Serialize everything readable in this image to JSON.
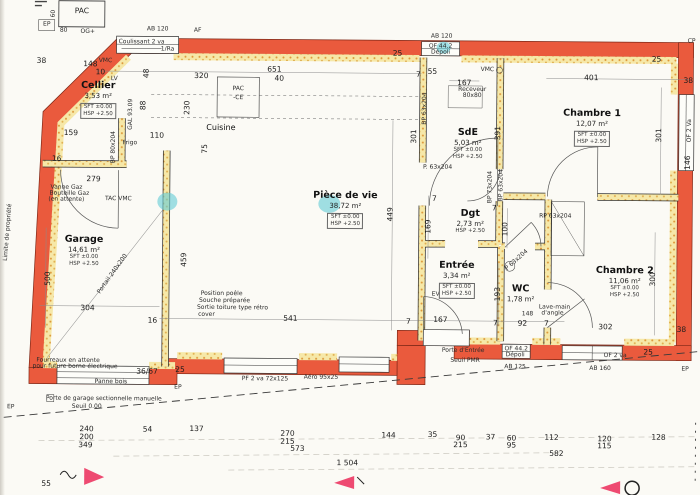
{
  "colors": {
    "wall_red": "#ea5a3d",
    "wall_edge": "#7f2817",
    "hatch_yellow": "#f6e8a8",
    "hatch_dot": "#dd9738",
    "highlight_cyan": "#63ccd6",
    "marker_pink": "#ee4a71",
    "paper": "#fbfaf5",
    "ink": "#1c1c1c"
  },
  "rooms": [
    {
      "name": "Cellier",
      "area": "3,53 m²",
      "info": [
        "SFT ±0.00",
        "HSP +2.50"
      ],
      "boxed": true,
      "x": 97,
      "y": 82
    },
    {
      "name": "Garage",
      "area": "14,61 m²",
      "info": [
        "SFT ±0.00",
        "HSP +2.50"
      ],
      "boxed": false,
      "x": 84,
      "y": 236
    },
    {
      "name": "Cuisine",
      "area": "",
      "info": [],
      "boxed": false,
      "x": 220,
      "y": 124,
      "small": true
    },
    {
      "name": "Pièce de vie",
      "area": "38,72 m²",
      "info": [
        "SFT ±0.00",
        "HSP +2.50"
      ],
      "boxed": true,
      "x": 345,
      "y": 190
    },
    {
      "name": "SdE",
      "area": "5,03 m²",
      "info": [
        "SFT ±0.00",
        "HSP +2.50"
      ],
      "boxed": false,
      "x": 467,
      "y": 126
    },
    {
      "name": "Chambre 1",
      "area": "12,07 m²",
      "info": [
        "SFT ±0.00",
        "HSP +2.50"
      ],
      "boxed": true,
      "x": 591,
      "y": 106
    },
    {
      "name": "Dgt",
      "area": "2,73 m²",
      "info": [
        "HSP +2.50"
      ],
      "boxed": false,
      "x": 470,
      "y": 207
    },
    {
      "name": "Entrée",
      "area": "3,34 m²",
      "info": [
        "SFT ±0.00",
        "HSP +2.50"
      ],
      "boxed": true,
      "x": 457,
      "y": 259
    },
    {
      "name": "WC",
      "area": "1,78 m²",
      "info": [],
      "boxed": false,
      "x": 521,
      "y": 282
    },
    {
      "name": "Chambre 2",
      "area": "11,06 m²",
      "info": [
        "SFT ±0.00",
        "HSP +2.50"
      ],
      "boxed": false,
      "x": 625,
      "y": 263
    }
  ],
  "labels": [
    {
      "t": "PAC",
      "x": 80,
      "y": 13,
      "c": "d"
    },
    {
      "t": "60",
      "x": 52,
      "y": 16,
      "c": "t",
      "r": -90
    },
    {
      "t": "80",
      "x": 62,
      "y": 33,
      "c": "t"
    },
    {
      "t": "OG+",
      "x": 86,
      "y": 34,
      "c": "t"
    },
    {
      "t": "EP",
      "x": 45,
      "y": 27,
      "c": "t"
    },
    {
      "t": "AB 120",
      "x": 156,
      "y": 31,
      "c": "t"
    },
    {
      "t": "Coulissant 2 va",
      "x": 140,
      "y": 44,
      "c": "t"
    },
    {
      "t": "1/Ra",
      "x": 166,
      "y": 51,
      "c": "t"
    },
    {
      "t": "AF",
      "x": 196,
      "y": 32,
      "c": "t"
    },
    {
      "t": "38",
      "x": 40,
      "y": 63,
      "c": "d"
    },
    {
      "t": "VMC",
      "x": 104,
      "y": 63,
      "c": "t"
    },
    {
      "t": "148",
      "x": 89,
      "y": 66,
      "c": "d"
    },
    {
      "t": "10",
      "x": 99,
      "y": 74,
      "c": "d"
    },
    {
      "t": "LV",
      "x": 113,
      "y": 81,
      "c": "t"
    },
    {
      "t": "48",
      "x": 145,
      "y": 75,
      "c": "d",
      "r": -90
    },
    {
      "t": "320",
      "x": 200,
      "y": 77,
      "c": "d"
    },
    {
      "t": "651",
      "x": 273,
      "y": 70,
      "c": "d"
    },
    {
      "t": "40",
      "x": 278,
      "y": 79,
      "c": "d"
    },
    {
      "t": "25",
      "x": 396,
      "y": 53,
      "c": "d"
    },
    {
      "t": "AB 120",
      "x": 440,
      "y": 36,
      "c": "t"
    },
    {
      "t": "OF 44.2",
      "x": 439,
      "y": 46,
      "c": "t"
    },
    {
      "t": "Dépoli",
      "x": 439,
      "y": 52,
      "c": "t"
    },
    {
      "t": "55",
      "x": 431,
      "y": 71,
      "c": "d"
    },
    {
      "t": "7",
      "x": 417,
      "y": 74,
      "c": "d"
    },
    {
      "t": "167",
      "x": 463,
      "y": 82,
      "c": "d"
    },
    {
      "t": "Receveur",
      "x": 471,
      "y": 89,
      "c": "t"
    },
    {
      "t": "80x80",
      "x": 471,
      "y": 95,
      "c": "t"
    },
    {
      "t": "VMC",
      "x": 486,
      "y": 69,
      "c": "t"
    },
    {
      "t": "401",
      "x": 590,
      "y": 76,
      "c": "d"
    },
    {
      "t": "25",
      "x": 655,
      "y": 57,
      "c": "d"
    },
    {
      "t": "38",
      "x": 687,
      "y": 78,
      "c": "d"
    },
    {
      "t": "CP",
      "x": 690,
      "y": 39,
      "c": "t"
    },
    {
      "t": "PAC",
      "x": 237,
      "y": 90,
      "c": "t"
    },
    {
      "t": "-CE",
      "x": 237,
      "y": 99,
      "c": "t"
    },
    {
      "t": "88",
      "x": 142,
      "y": 107,
      "c": "d",
      "r": -90
    },
    {
      "t": "230",
      "x": 186,
      "y": 109,
      "c": "d",
      "r": -90
    },
    {
      "t": "GAL 93.09",
      "x": 130,
      "y": 116,
      "c": "t",
      "r": -90
    },
    {
      "t": "BP 80x204",
      "x": 113,
      "y": 149,
      "c": "t",
      "r": -90
    },
    {
      "t": "Frigo",
      "x": 129,
      "y": 145,
      "c": "t"
    },
    {
      "t": "110",
      "x": 156,
      "y": 137,
      "c": "d"
    },
    {
      "t": "75",
      "x": 204,
      "y": 150,
      "c": "d",
      "r": -90
    },
    {
      "t": "159",
      "x": 70,
      "y": 135,
      "c": "d"
    },
    {
      "t": "16",
      "x": 56,
      "y": 161,
      "c": "d"
    },
    {
      "t": "279",
      "x": 93,
      "y": 181,
      "c": "d"
    },
    {
      "t": "TAC VMC",
      "x": 118,
      "y": 201,
      "c": "t"
    },
    {
      "t": "Vanne Gaz",
      "x": 66,
      "y": 190,
      "c": "t"
    },
    {
      "t": "Bouteille Gaz",
      "x": 69,
      "y": 196,
      "c": "t"
    },
    {
      "t": "(en attente)",
      "x": 66,
      "y": 202,
      "c": "t"
    },
    {
      "t": "500",
      "x": 48,
      "y": 281,
      "c": "d",
      "r": -90
    },
    {
      "t": "459",
      "x": 184,
      "y": 261,
      "c": "d",
      "r": -90
    },
    {
      "t": "Portail 240x200",
      "x": 113,
      "y": 276,
      "c": "t",
      "r": -55
    },
    {
      "t": "304",
      "x": 88,
      "y": 310,
      "c": "d"
    },
    {
      "t": "16",
      "x": 153,
      "y": 322,
      "c": "d"
    },
    {
      "t": "Position poêle",
      "x": 222,
      "y": 295,
      "c": "t"
    },
    {
      "t": "Souche préparée",
      "x": 225,
      "y": 302,
      "c": "t"
    },
    {
      "t": "Sortie toiture type rétro",
      "x": 233,
      "y": 309,
      "c": "t"
    },
    {
      "t": "cover",
      "x": 207,
      "y": 316,
      "c": "t"
    },
    {
      "t": "541",
      "x": 291,
      "y": 319,
      "c": "d"
    },
    {
      "t": "7",
      "x": 409,
      "y": 321,
      "c": "d"
    },
    {
      "t": "167",
      "x": 441,
      "y": 319,
      "c": "d"
    },
    {
      "t": "7",
      "x": 496,
      "y": 322,
      "c": "d"
    },
    {
      "t": "92",
      "x": 523,
      "y": 322,
      "c": "d"
    },
    {
      "t": "7",
      "x": 547,
      "y": 322,
      "c": "d"
    },
    {
      "t": "449",
      "x": 390,
      "y": 214,
      "c": "d",
      "r": -90
    },
    {
      "t": "169",
      "x": 428,
      "y": 226,
      "c": "d",
      "r": -90
    },
    {
      "t": "EV",
      "x": 436,
      "y": 294,
      "c": "t"
    },
    {
      "t": "301",
      "x": 413,
      "y": 136,
      "c": "d",
      "r": -90
    },
    {
      "t": "391",
      "x": 497,
      "y": 132,
      "c": "d",
      "r": -90
    },
    {
      "t": "P. 63x204",
      "x": 437,
      "y": 167,
      "c": "t"
    },
    {
      "t": "BP 63x204",
      "x": 424,
      "y": 108,
      "c": "t",
      "r": -90
    },
    {
      "t": "BP 73x204",
      "x": 490,
      "y": 186,
      "c": "t",
      "r": -90
    },
    {
      "t": "BP 63x204",
      "x": 501,
      "y": 184,
      "c": "t",
      "r": -90
    },
    {
      "t": "7",
      "x": 434,
      "y": 198,
      "c": "d"
    },
    {
      "t": "7",
      "x": 494,
      "y": 207,
      "c": "d"
    },
    {
      "t": "100",
      "x": 505,
      "y": 228,
      "c": "d",
      "r": -90
    },
    {
      "t": "RP 63x204",
      "x": 555,
      "y": 215,
      "c": "t"
    },
    {
      "t": "301",
      "x": 658,
      "y": 133,
      "c": "d",
      "r": -90
    },
    {
      "t": "OF 2 Va",
      "x": 689,
      "y": 128,
      "c": "t",
      "r": -90
    },
    {
      "t": "146",
      "x": 687,
      "y": 160,
      "c": "d",
      "r": -90
    },
    {
      "t": "193",
      "x": 498,
      "y": 293,
      "c": "d",
      "r": -90
    },
    {
      "t": "P 63x204",
      "x": 517,
      "y": 259,
      "c": "t",
      "r": -42
    },
    {
      "t": "148",
      "x": 528,
      "y": 313,
      "c": "t"
    },
    {
      "t": "Lave-main",
      "x": 555,
      "y": 306,
      "c": "t"
    },
    {
      "t": "d'angle",
      "x": 553,
      "y": 312,
      "c": "t"
    },
    {
      "t": "302",
      "x": 606,
      "y": 325,
      "c": "d"
    },
    {
      "t": "38",
      "x": 682,
      "y": 327,
      "c": "d"
    },
    {
      "t": "300",
      "x": 653,
      "y": 277,
      "c": "d",
      "r": -90
    },
    {
      "t": "25",
      "x": 649,
      "y": 350,
      "c": "d"
    },
    {
      "t": "OF 2 va",
      "x": 616,
      "y": 354,
      "c": "t"
    },
    {
      "t": "AB 160",
      "x": 601,
      "y": 367,
      "c": "t"
    },
    {
      "t": "OF 44.2",
      "x": 517,
      "y": 348,
      "c": "t"
    },
    {
      "t": "Dépoli",
      "x": 516,
      "y": 354,
      "c": "t"
    },
    {
      "t": "AB 125",
      "x": 516,
      "y": 366,
      "c": "t"
    },
    {
      "t": "Porte d'Entrée",
      "x": 464,
      "y": 350,
      "c": "t"
    },
    {
      "t": "Seuil PMR",
      "x": 466,
      "y": 360,
      "c": "t"
    },
    {
      "t": "EP",
      "x": 686,
      "y": 367,
      "c": "t"
    },
    {
      "t": "25",
      "x": 181,
      "y": 371,
      "c": "d"
    },
    {
      "t": "36/67",
      "x": 148,
      "y": 373,
      "c": "d"
    },
    {
      "t": "Panne bois",
      "x": 112,
      "y": 384,
      "c": "t"
    },
    {
      "t": "Fourreaux en attente",
      "x": 69,
      "y": 363,
      "c": "t"
    },
    {
      "t": "pour future borne électrique",
      "x": 76,
      "y": 369,
      "c": "t"
    },
    {
      "t": "EP",
      "x": 179,
      "y": 389,
      "c": "t"
    },
    {
      "t": "Porte de garage sectionnelle manuelle",
      "x": 105,
      "y": 401,
      "c": "t"
    },
    {
      "t": "Seuil 0.00",
      "x": 88,
      "y": 409,
      "c": "t"
    },
    {
      "t": "EP",
      "x": 12,
      "y": 410,
      "c": "t"
    },
    {
      "t": "Limite de propriété",
      "x": 8,
      "y": 235,
      "c": "t",
      "r": -86
    },
    {
      "t": "PF 2 va 72x125",
      "x": 266,
      "y": 380,
      "c": "t"
    },
    {
      "t": "Aéro 95x25",
      "x": 322,
      "y": 378,
      "c": "t"
    },
    {
      "t": "55",
      "x": 48,
      "y": 486,
      "c": "d"
    },
    {
      "t": "240",
      "x": 88,
      "y": 431,
      "c": "d"
    },
    {
      "t": "200",
      "x": 88,
      "y": 439,
      "c": "d"
    },
    {
      "t": "349",
      "x": 87,
      "y": 447,
      "c": "d"
    },
    {
      "t": "54",
      "x": 149,
      "y": 431,
      "c": "d"
    },
    {
      "t": "137",
      "x": 198,
      "y": 430,
      "c": "d"
    },
    {
      "t": "270",
      "x": 289,
      "y": 434,
      "c": "d"
    },
    {
      "t": "215",
      "x": 289,
      "y": 442,
      "c": "d"
    },
    {
      "t": "573",
      "x": 299,
      "y": 449,
      "c": "d"
    },
    {
      "t": "144",
      "x": 390,
      "y": 435,
      "c": "d"
    },
    {
      "t": "35",
      "x": 434,
      "y": 434,
      "c": "d"
    },
    {
      "t": "90",
      "x": 462,
      "y": 437,
      "c": "d"
    },
    {
      "t": "215",
      "x": 462,
      "y": 444,
      "c": "d"
    },
    {
      "t": "37",
      "x": 492,
      "y": 436,
      "c": "d"
    },
    {
      "t": "60",
      "x": 513,
      "y": 437,
      "c": "d"
    },
    {
      "t": "95",
      "x": 513,
      "y": 444,
      "c": "d"
    },
    {
      "t": "112",
      "x": 553,
      "y": 436,
      "c": "d"
    },
    {
      "t": "582",
      "x": 558,
      "y": 452,
      "c": "d"
    },
    {
      "t": "120",
      "x": 606,
      "y": 437,
      "c": "d"
    },
    {
      "t": "115",
      "x": 606,
      "y": 444,
      "c": "d"
    },
    {
      "t": "128",
      "x": 660,
      "y": 435,
      "c": "d"
    },
    {
      "t": "1 504",
      "x": 349,
      "y": 463,
      "c": "d"
    }
  ]
}
